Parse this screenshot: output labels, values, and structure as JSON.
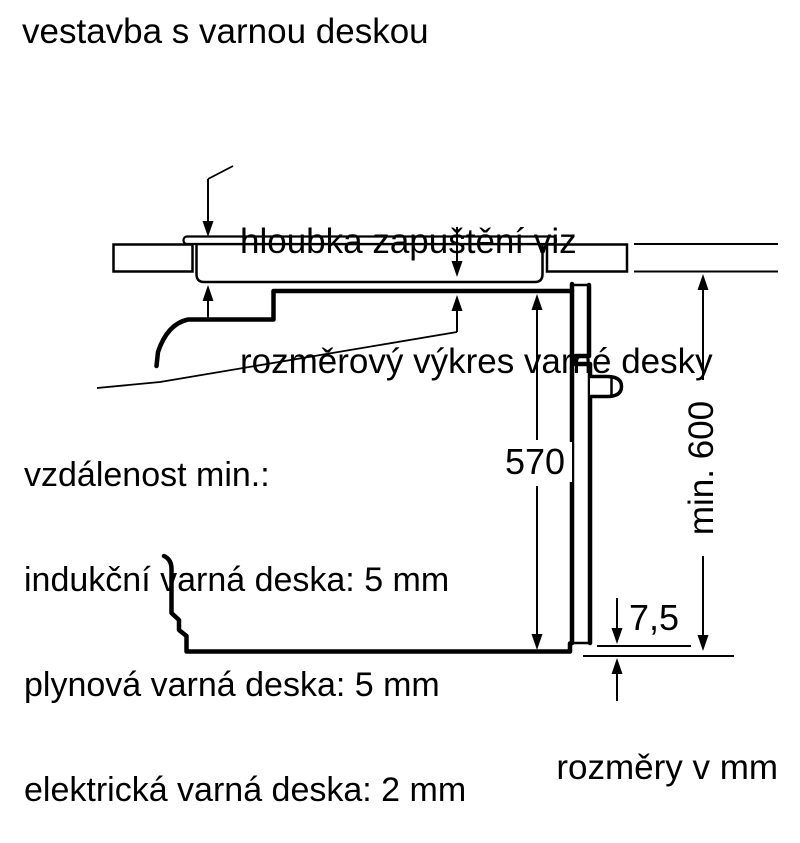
{
  "title": "vestavba s varnou deskou",
  "footer": "rozměry v mm",
  "annotation": {
    "line1": "hloubka zapuštění viz",
    "line2": "rozměrový výkres varné desky"
  },
  "clearance_note": {
    "line1": "vzdálenost min.:",
    "line2": "indukční varná deska: 5 mm",
    "line3": "plynová varná deska: 5 mm",
    "line4": "elektrická varná deska: 2 mm"
  },
  "dimensions": {
    "cavity_height": "570",
    "min_niche_height": "min. 600",
    "door_overhang": "7,5"
  },
  "colors": {
    "line": "#000000",
    "background": "#ffffff"
  }
}
